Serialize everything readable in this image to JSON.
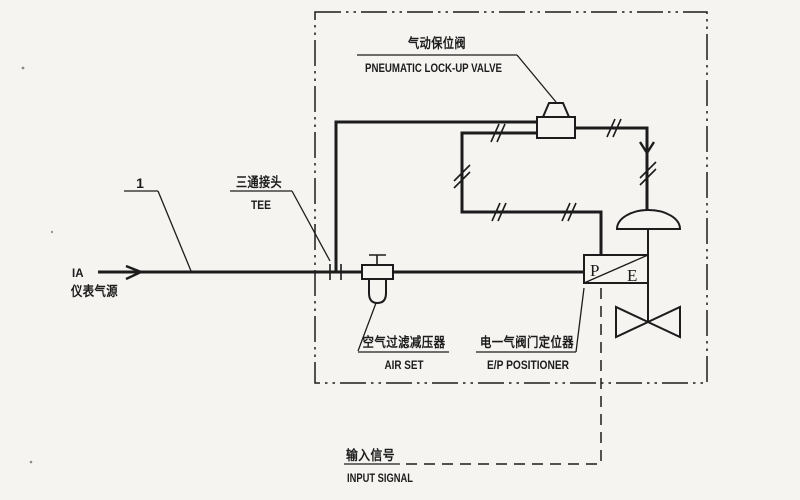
{
  "labels": {
    "callout_number": "1",
    "instrument_air_code": "IA",
    "instrument_air_cn": "仪表气源",
    "tee_cn": "三通接头",
    "tee_en": "TEE",
    "lockup_cn": "气动保位阀",
    "lockup_en": "PNEUMATIC LOCK-UP VALVE",
    "airset_cn": "空气过滤减压器",
    "airset_en": "AIR SET",
    "positioner_cn": "电一气阀门定位器",
    "positioner_en": "E/P POSITIONER",
    "input_signal_cn": "输入信号",
    "input_signal_en": "INPUT SIGNAL",
    "positioner_p": "P",
    "positioner_e": "E"
  },
  "colors": {
    "ink": "#1c1c1c",
    "paper": "#f5f4f0"
  }
}
